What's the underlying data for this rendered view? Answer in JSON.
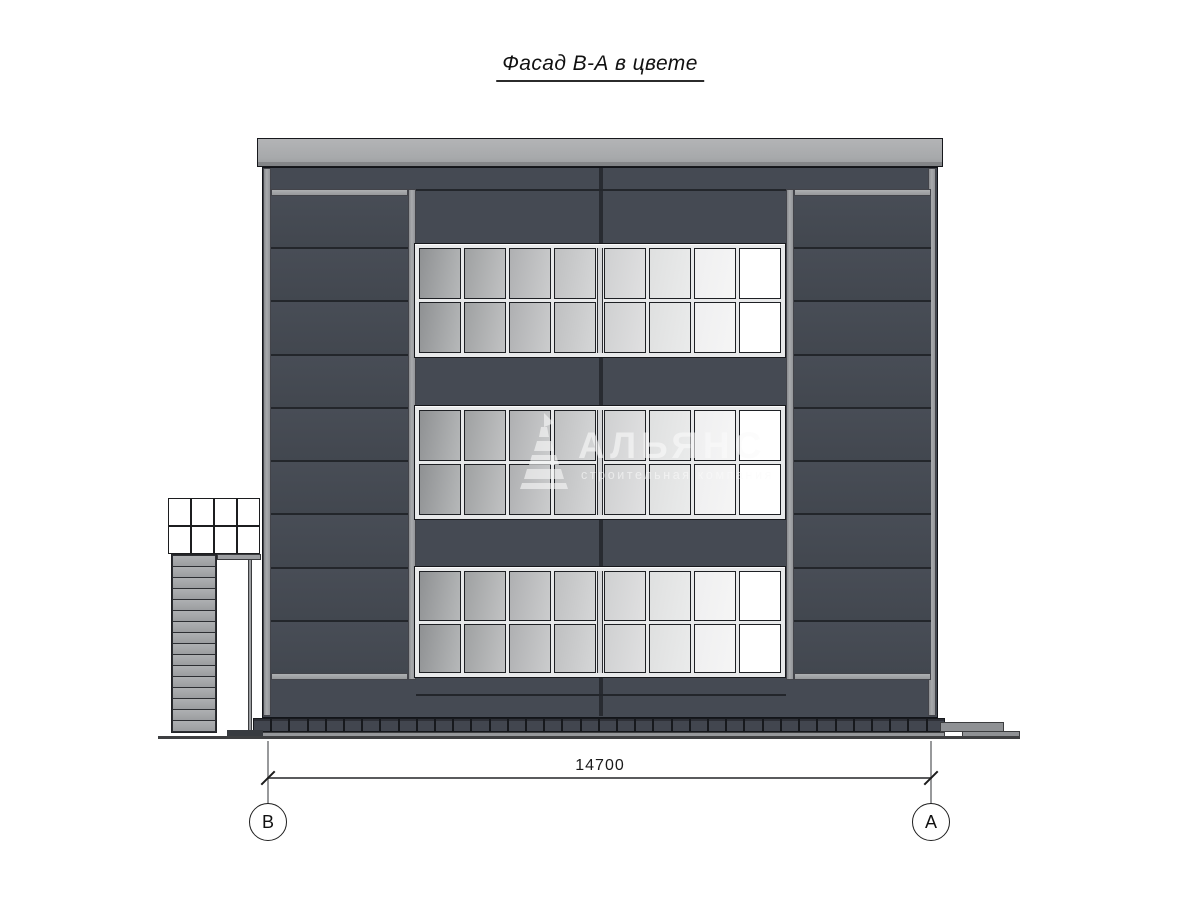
{
  "title": "Фасад В-А в цвете",
  "dimension_label": "14700",
  "axis_left": "В",
  "axis_right": "А",
  "watermark": {
    "brand": "АЛЬЯНС",
    "tagline": "строительная компания"
  },
  "colors": {
    "panel_dark": "#454a53",
    "panel_seam": "#24272c",
    "trim_light": "#9c9ea1",
    "cornice_gray": "#a9abad",
    "window_frame": "#e8e9ea",
    "pane_darkest": "#8f9193",
    "pane_lightest": "#ffffff",
    "plinth_tile": "#42464f",
    "ground_line": "#3e3f41"
  },
  "structure": {
    "window_bands": 3,
    "band_columns": 8,
    "band_rows": 2,
    "side_panel_rows": 9,
    "plinth_tiles": 38,
    "annex_glazing_cols": 4,
    "annex_glazing_rows": 2,
    "annex_stripes": 16
  }
}
